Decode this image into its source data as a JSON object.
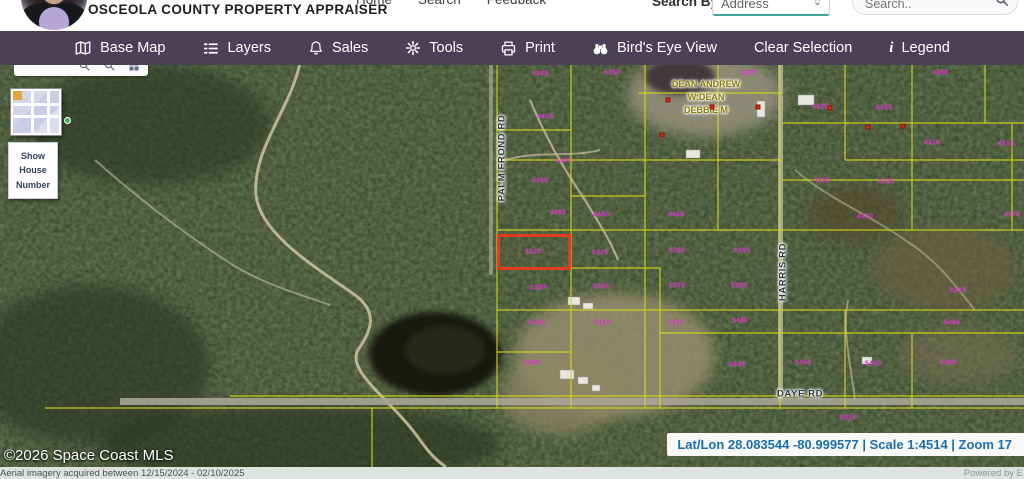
{
  "header": {
    "brand": "OSCEOLA COUNTY PROPERTY APPRAISER",
    "nav": [
      {
        "label": "Home"
      },
      {
        "label": "Search"
      },
      {
        "label": "Feedback"
      }
    ],
    "search_by": {
      "label": "Search By",
      "selected": "Address"
    },
    "search": {
      "placeholder": "Search.."
    }
  },
  "toolbar": {
    "bg_color": "#4a4156",
    "items": [
      {
        "icon": "map-icon",
        "label": "Base Map"
      },
      {
        "icon": "layers-icon",
        "label": "Layers"
      },
      {
        "icon": "bell-icon",
        "label": "Sales"
      },
      {
        "icon": "gear-icon",
        "label": "Tools"
      },
      {
        "icon": "printer-icon",
        "label": "Print"
      },
      {
        "icon": "binoculars-icon",
        "label": "Bird's Eye View"
      },
      {
        "icon": "",
        "label": "Clear Selection"
      },
      {
        "icon": "info-icon",
        "label": "Legend"
      }
    ]
  },
  "map": {
    "widgets": {
      "show_house_number": "Show House Number"
    },
    "road_labels": [
      {
        "text": "PALM FROND RD",
        "x": 502,
        "y": 93,
        "rotate": -90
      },
      {
        "text": "HARRIS RD",
        "x": 783,
        "y": 207,
        "rotate": -90
      },
      {
        "text": "DAYE RD",
        "x": 800,
        "y": 329,
        "rotate": 0
      }
    ],
    "owner_label": {
      "lines": [
        "DEAN ANDREW",
        "W;DEAN",
        "DEBBIE M"
      ]
    },
    "selected_parcel": {
      "x": 497,
      "y": 169,
      "width": 74,
      "height": 36,
      "color": "#e23b20"
    },
    "parcel_numbers": [
      {
        "t": "4345",
        "x": 540,
        "y": 9
      },
      {
        "t": "4350",
        "x": 612,
        "y": 8
      },
      {
        "t": "4355",
        "x": 748,
        "y": 8
      },
      {
        "t": "4360",
        "x": 940,
        "y": 8
      },
      {
        "t": "4410",
        "x": 545,
        "y": 52
      },
      {
        "t": "4420",
        "x": 820,
        "y": 42
      },
      {
        "t": "4425",
        "x": 884,
        "y": 43
      },
      {
        "t": "4440",
        "x": 563,
        "y": 96
      },
      {
        "t": "4310",
        "x": 932,
        "y": 78
      },
      {
        "t": "4315",
        "x": 1006,
        "y": 79
      },
      {
        "t": "4450",
        "x": 540,
        "y": 116
      },
      {
        "t": "4330",
        "x": 822,
        "y": 116
      },
      {
        "t": "4335",
        "x": 886,
        "y": 117
      },
      {
        "t": "4455",
        "x": 558,
        "y": 148
      },
      {
        "t": "4460",
        "x": 601,
        "y": 150
      },
      {
        "t": "4465",
        "x": 676,
        "y": 150
      },
      {
        "t": "4470",
        "x": 865,
        "y": 152
      },
      {
        "t": "4475",
        "x": 1012,
        "y": 150
      },
      {
        "t": "5230",
        "x": 533,
        "y": 187
      },
      {
        "t": "5245",
        "x": 600,
        "y": 188
      },
      {
        "t": "5250",
        "x": 677,
        "y": 186
      },
      {
        "t": "5255",
        "x": 742,
        "y": 186
      },
      {
        "t": "5290",
        "x": 538,
        "y": 223
      },
      {
        "t": "5300",
        "x": 601,
        "y": 222
      },
      {
        "t": "5370",
        "x": 677,
        "y": 221
      },
      {
        "t": "5320",
        "x": 739,
        "y": 221
      },
      {
        "t": "5375",
        "x": 958,
        "y": 226
      },
      {
        "t": "5400",
        "x": 537,
        "y": 258
      },
      {
        "t": "5410",
        "x": 602,
        "y": 258
      },
      {
        "t": "5470",
        "x": 676,
        "y": 258
      },
      {
        "t": "5480",
        "x": 740,
        "y": 256
      },
      {
        "t": "5485",
        "x": 952,
        "y": 258
      },
      {
        "t": "5460",
        "x": 532,
        "y": 298
      },
      {
        "t": "5440",
        "x": 737,
        "y": 300
      },
      {
        "t": "5450",
        "x": 803,
        "y": 298
      },
      {
        "t": "5490",
        "x": 873,
        "y": 299
      },
      {
        "t": "5495",
        "x": 948,
        "y": 298
      },
      {
        "t": "5810",
        "x": 848,
        "y": 353
      }
    ],
    "sales_markers": [
      {
        "x": 668,
        "y": 35
      },
      {
        "x": 712,
        "y": 42
      },
      {
        "x": 758,
        "y": 42
      },
      {
        "x": 830,
        "y": 43
      },
      {
        "x": 868,
        "y": 62
      },
      {
        "x": 903,
        "y": 61
      },
      {
        "x": 662,
        "y": 70
      }
    ],
    "copyright": "©2026 Space Coast MLS",
    "status_bar": {
      "text": "Lat/Lon 28.083544 -80.999577 | Scale 1:4514 | Zoom 17",
      "color": "#1a6fae"
    },
    "colors": {
      "parcel_line": "#d4d61f",
      "parcel_number": "#cf2ebe",
      "selection": "#e23b20"
    }
  },
  "footer": {
    "imagery_note": "Aerial imagery acquired between 12/15/2024 - 02/10/2025",
    "powered_by": "Powered by E"
  }
}
